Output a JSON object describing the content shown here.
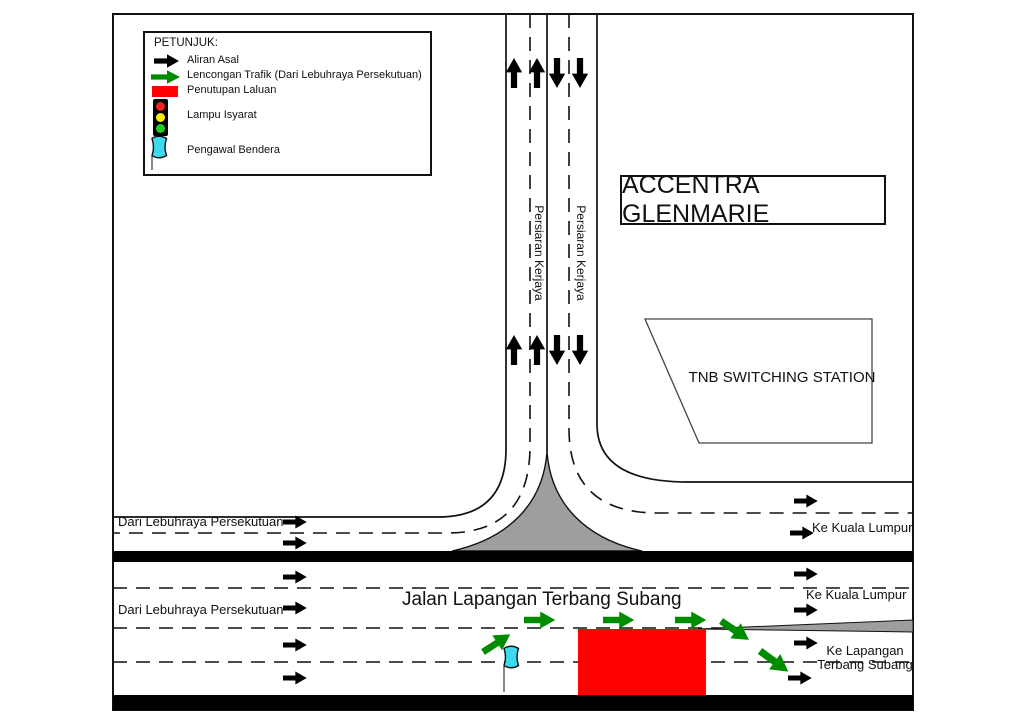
{
  "legend": {
    "title": "PETUNJUK:",
    "items": [
      {
        "name": "aliran-asal",
        "label": "Aliran Asal"
      },
      {
        "name": "lencongan-trafik",
        "label": "Lencongan Trafik (Dari Lebuhraya Persekutuan)"
      },
      {
        "name": "penutupan-laluan",
        "label": "Penutupan Laluan"
      },
      {
        "name": "lampu-isyarat",
        "label": "Lampu Isyarat"
      },
      {
        "name": "pengawal-bendera",
        "label": "Pengawal Bendera"
      }
    ]
  },
  "map": {
    "buildings": {
      "accentra": "ACCENTRA GLENMARIE",
      "tnb": "TNB SWITCHING STATION"
    },
    "roads": {
      "persiaran_left": "Persiaran Kerjaya",
      "persiaran_right": "Persiaran Kerjaya",
      "jalan": "Jalan Lapangan Terbang Subang"
    },
    "directions": {
      "dari_lebuhraya_upper": "Dari Lebuhraya Persekutuan",
      "dari_lebuhraya_lower": "Dari Lebuhraya Persekutuan",
      "ke_kl_upper": "Ke Kuala Lumpur",
      "ke_kl_lower": "Ke Kuala Lumpur",
      "ke_lapangan_line1": "Ke Lapangan",
      "ke_lapangan_line2": "Terbang Subang"
    }
  },
  "colors": {
    "original_flow": "#000000",
    "diversion_green": "#008C00",
    "closure_red": "#FF0000",
    "flag_cyan": "#3FD9EF",
    "island_gray": "#9E9E9E"
  }
}
